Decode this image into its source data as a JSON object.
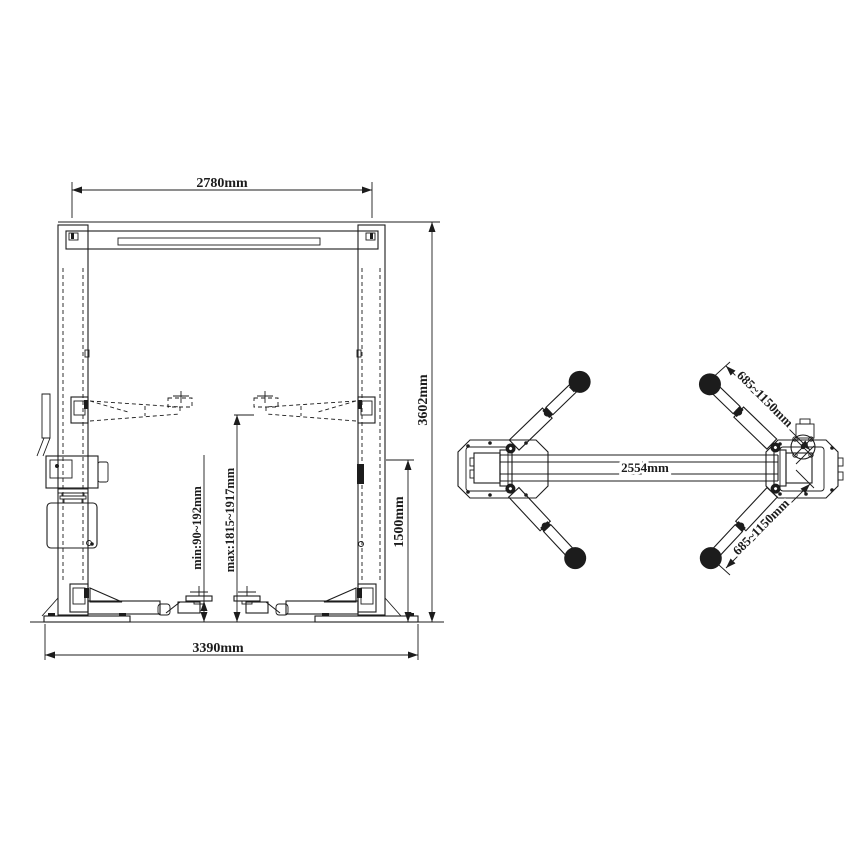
{
  "colors": {
    "line": "#1c1c1c",
    "background": "#ffffff"
  },
  "front_view": {
    "dims": {
      "top_width": "2780mm",
      "total_height": "3602mm",
      "base_width": "3390mm",
      "carriage_height": "1500mm",
      "pad_min_height": "min:90~192mm",
      "pad_max_height": "max:1815~1917mm"
    }
  },
  "top_view": {
    "dims": {
      "post_spacing": "2554mm",
      "upper_arm_reach": "685~1150mm",
      "lower_arm_reach": "685~1150mm"
    }
  }
}
